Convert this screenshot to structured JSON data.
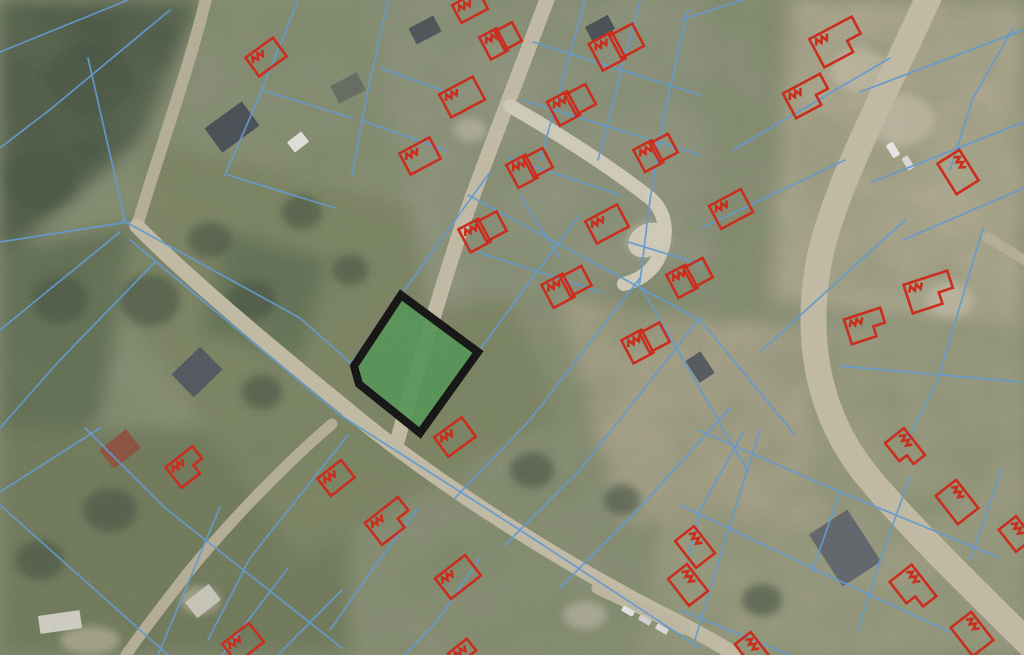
{
  "view": {
    "kind": "aerial-cadastral-map",
    "width": 1024,
    "height": 655
  },
  "palette": {
    "base": "#868c72",
    "forest_dark": "#44513f",
    "forest_mid": "#5a684e",
    "green_lowerleft": "#6d7557",
    "olive_center": "#7a8160",
    "pale_housing": "#8e927c",
    "tan_right": "#b1a991",
    "tan_olive_rb": "#9c9b81",
    "mid_dirt": "#a8a189",
    "dark_grove": "#5c6a50",
    "road_main": "#c1b9a3",
    "road_pale": "#d0cab7",
    "road_dirt": "#b4ac94",
    "parcel_boundary": "#5d97d1",
    "building_outline": "#cb2212",
    "highlight_fill": "#4f9352",
    "highlight_border": "#0a0a0a"
  },
  "map": {
    "patches": [
      {
        "pts": [
          [
            0,
            0
          ],
          [
            200,
            0
          ],
          [
            140,
            140
          ],
          [
            0,
            260
          ]
        ],
        "c": "#44513f"
      },
      {
        "pts": [
          [
            0,
            250
          ],
          [
            135,
            225
          ],
          [
            100,
            420
          ],
          [
            0,
            470
          ]
        ],
        "c": "#5a684e"
      },
      {
        "pts": [
          [
            0,
            430
          ],
          [
            345,
            430
          ],
          [
            350,
            655
          ],
          [
            0,
            655
          ]
        ],
        "c": "#6d7557"
      },
      {
        "pts": [
          [
            150,
            140
          ],
          [
            480,
            220
          ],
          [
            560,
            420
          ],
          [
            300,
            560
          ],
          [
            130,
            320
          ]
        ],
        "c": "#7a8160"
      },
      {
        "pts": [
          [
            370,
            0
          ],
          [
            700,
            0
          ],
          [
            720,
            260
          ],
          [
            430,
            310
          ]
        ],
        "c": "#8e927c"
      },
      {
        "pts": [
          [
            790,
            0
          ],
          [
            1024,
            0
          ],
          [
            1024,
            330
          ],
          [
            770,
            300
          ]
        ],
        "c": "#b1a991"
      },
      {
        "pts": [
          [
            690,
            320
          ],
          [
            1024,
            330
          ],
          [
            1024,
            655
          ],
          [
            640,
            655
          ]
        ],
        "c": "#9c9b81"
      },
      {
        "pts": [
          [
            560,
            300
          ],
          [
            800,
            330
          ],
          [
            820,
            520
          ],
          [
            620,
            520
          ]
        ],
        "c": "#a8a189"
      },
      {
        "pts": [
          [
            230,
            230
          ],
          [
            330,
            260
          ],
          [
            300,
            360
          ],
          [
            200,
            330
          ]
        ],
        "c": "#5c6a50"
      }
    ],
    "glades": [
      [
        900,
        120,
        34,
        26
      ],
      [
        860,
        70,
        28,
        22
      ],
      [
        950,
        300,
        24,
        18
      ],
      [
        648,
        240,
        22,
        17
      ],
      [
        585,
        615,
        22,
        14
      ],
      [
        200,
        600,
        20,
        14
      ],
      [
        90,
        640,
        30,
        14
      ],
      [
        470,
        130,
        16,
        12
      ]
    ],
    "trees": [
      [
        90,
        80,
        44,
        36
      ],
      [
        40,
        180,
        36,
        30
      ],
      [
        150,
        300,
        30,
        26
      ],
      [
        60,
        300,
        28,
        24
      ],
      [
        252,
        300,
        24,
        20
      ],
      [
        302,
        212,
        20,
        17
      ],
      [
        110,
        510,
        27,
        22
      ],
      [
        40,
        560,
        24,
        20
      ],
      [
        262,
        392,
        20,
        17
      ],
      [
        532,
        470,
        22,
        18
      ],
      [
        622,
        500,
        18,
        15
      ],
      [
        762,
        600,
        20,
        16
      ],
      [
        350,
        270,
        18,
        15
      ],
      [
        210,
        240,
        22,
        18
      ]
    ],
    "roads": [
      {
        "d": "M 207,-6 C 192,60 158,155 137,226",
        "w": 12,
        "c": "#b4ac94"
      },
      {
        "d": "M 549,-6 C 517,80 482,168 462,226 C 441,290 415,378 397,442",
        "w": 15,
        "c": "#c1b9a3"
      },
      {
        "d": "M 137,226 C 192,282 282,356 347,409 C 422,472 542,552 662,614 C 692,629 714,641 736,655",
        "w": 15,
        "c": "#c1b9a3"
      },
      {
        "d": "M 332,424 C 292,458 232,518 187,574 C 162,606 142,632 126,655",
        "w": 11,
        "c": "#b4ac94"
      },
      {
        "d": "M 930,-6 C 892,80 837,180 820,256 C 804,336 817,412 864,472 C 907,525 972,587 1032,647",
        "w": 26,
        "c": "#c1b9a3"
      },
      {
        "d": "M 987,237 L 1034,266",
        "w": 10,
        "c": "#b4ac94"
      },
      {
        "d": "M 510,106 C 556,132 612,168 650,198 C 666,212 668,232 661,252 C 655,270 640,280 624,284",
        "w": 14,
        "c": "#d0cab7"
      },
      {
        "d": "M 598,588 L 684,628",
        "w": 13,
        "c": "#bdb59f"
      }
    ],
    "road_bulbs": [
      [
        648,
        240,
        21,
        16,
        -30
      ]
    ],
    "parcel_lines": [
      [
        [
          128,
          0
        ],
        [
          0,
          52
        ]
      ],
      [
        [
          170,
          10
        ],
        [
          52,
          108
        ],
        [
          0,
          148
        ]
      ],
      [
        [
          88,
          58
        ],
        [
          125,
          220
        ]
      ],
      [
        [
          0,
          242
        ],
        [
          128,
          222
        ]
      ],
      [
        [
          120,
          232
        ],
        [
          0,
          330
        ]
      ],
      [
        [
          155,
          262
        ],
        [
          60,
          360
        ],
        [
          0,
          428
        ]
      ],
      [
        [
          85,
          428
        ],
        [
          165,
          508
        ],
        [
          342,
          648
        ]
      ],
      [
        [
          0,
          505
        ],
        [
          168,
          655
        ]
      ],
      [
        [
          100,
          428
        ],
        [
          0,
          492
        ]
      ],
      [
        [
          220,
          507
        ],
        [
          158,
          655
        ]
      ],
      [
        [
          288,
          568
        ],
        [
          222,
          655
        ]
      ],
      [
        [
          342,
          590
        ],
        [
          278,
          655
        ]
      ],
      [
        [
          130,
          240
        ],
        [
          340,
          415
        ],
        [
          520,
          530
        ],
        [
          700,
          648
        ]
      ],
      [
        [
          122,
          220
        ],
        [
          300,
          318
        ],
        [
          354,
          366
        ]
      ],
      [
        [
          352,
          362
        ],
        [
          401,
          295
        ],
        [
          490,
          172
        ]
      ],
      [
        [
          478,
          352
        ],
        [
          540,
          268
        ],
        [
          580,
          215
        ]
      ],
      [
        [
          455,
          498
        ],
        [
          530,
          420
        ],
        [
          640,
          278
        ]
      ],
      [
        [
          505,
          545
        ],
        [
          580,
          470
        ],
        [
          700,
          318
        ]
      ],
      [
        [
          560,
          588
        ],
        [
          645,
          502
        ],
        [
          730,
          408
        ]
      ],
      [
        [
          468,
          195
        ],
        [
          700,
          320
        ]
      ],
      [
        [
          638,
          282
        ],
        [
          748,
          472
        ]
      ],
      [
        [
          700,
          320
        ],
        [
          795,
          435
        ]
      ],
      [
        [
          533,
          42
        ],
        [
          700,
          95
        ]
      ],
      [
        [
          522,
          100
        ],
        [
          700,
          155
        ]
      ],
      [
        [
          508,
          158
        ],
        [
          620,
          195
        ]
      ],
      [
        [
          628,
          242
        ],
        [
          700,
          264
        ]
      ],
      [
        [
          478,
          252
        ],
        [
          600,
          292
        ]
      ],
      [
        [
          585,
          0
        ],
        [
          560,
          90
        ],
        [
          540,
          160
        ]
      ],
      [
        [
          640,
          0
        ],
        [
          615,
          95
        ],
        [
          598,
          160
        ]
      ],
      [
        [
          688,
          10
        ],
        [
          665,
          110
        ],
        [
          650,
          200
        ],
        [
          640,
          282
        ]
      ],
      [
        [
          458,
          96
        ],
        [
          380,
          68
        ]
      ],
      [
        [
          445,
          150
        ],
        [
          360,
          120
        ]
      ],
      [
        [
          388,
          0
        ],
        [
          368,
          90
        ],
        [
          352,
          175
        ]
      ],
      [
        [
          298,
          0
        ],
        [
          262,
          90
        ],
        [
          225,
          175
        ]
      ],
      [
        [
          262,
          90
        ],
        [
          352,
          118
        ]
      ],
      [
        [
          228,
          175
        ],
        [
          335,
          208
        ]
      ],
      [
        [
          1013,
          28
        ],
        [
          973,
          98
        ],
        [
          950,
          170
        ]
      ],
      [
        [
          860,
          92
        ],
        [
          1023,
          30
        ]
      ],
      [
        [
          872,
          182
        ],
        [
          1024,
          122
        ]
      ],
      [
        [
          903,
          240
        ],
        [
          1024,
          188
        ]
      ],
      [
        [
          733,
          150
        ],
        [
          890,
          58
        ]
      ],
      [
        [
          680,
          20
        ],
        [
          743,
          0
        ]
      ],
      [
        [
          702,
          228
        ],
        [
          845,
          160
        ]
      ],
      [
        [
          905,
          220
        ],
        [
          760,
          352
        ]
      ],
      [
        [
          983,
          228
        ],
        [
          938,
          380
        ],
        [
          908,
          438
        ]
      ],
      [
        [
          840,
          366
        ],
        [
          1021,
          382
        ]
      ],
      [
        [
          698,
          430
        ],
        [
          840,
          492
        ],
        [
          1000,
          558
        ]
      ],
      [
        [
          680,
          505
        ],
        [
          823,
          573
        ],
        [
          950,
          632
        ]
      ],
      [
        [
          680,
          610
        ],
        [
          790,
          655
        ]
      ],
      [
        [
          760,
          430
        ],
        [
          712,
          582
        ],
        [
          695,
          640
        ]
      ],
      [
        [
          910,
          477
        ],
        [
          880,
          560
        ],
        [
          858,
          630
        ]
      ],
      [
        [
          1002,
          468
        ],
        [
          970,
          560
        ]
      ],
      [
        [
          840,
          492
        ],
        [
          812,
          572
        ]
      ],
      [
        [
          348,
          435
        ],
        [
          250,
          558
        ],
        [
          208,
          640
        ]
      ],
      [
        [
          418,
          508
        ],
        [
          372,
          570
        ],
        [
          330,
          630
        ]
      ],
      [
        [
          480,
          558
        ],
        [
          438,
          620
        ],
        [
          405,
          655
        ]
      ],
      [
        [
          520,
          195
        ],
        [
          560,
          258
        ]
      ],
      [
        [
          743,
          433
        ],
        [
          700,
          510
        ],
        [
          688,
          560
        ]
      ]
    ],
    "roofs": [
      [
        232,
        127,
        46,
        30,
        -36,
        "#3e464e"
      ],
      [
        197,
        372,
        40,
        32,
        -44,
        "#49505a"
      ],
      [
        845,
        548,
        62,
        46,
        57,
        "#585e66"
      ],
      [
        120,
        449,
        34,
        24,
        -38,
        "#8a4a38"
      ],
      [
        348,
        88,
        30,
        20,
        -28,
        "#5f655c"
      ],
      [
        298,
        142,
        18,
        13,
        -38,
        "#e6e6e0"
      ],
      [
        203,
        601,
        30,
        20,
        -38,
        "#c9c6bb"
      ],
      [
        60,
        622,
        42,
        18,
        -8,
        "#d4d2c8"
      ],
      [
        700,
        367,
        26,
        18,
        57,
        "#4a5056"
      ],
      [
        425,
        30,
        28,
        18,
        -28,
        "#454c52"
      ],
      [
        600,
        28,
        26,
        16,
        -28,
        "#3f464d"
      ]
    ],
    "cars": [
      [
        893,
        150,
        15,
        8,
        58,
        "#e8e8e8"
      ],
      [
        908,
        163,
        14,
        7,
        58,
        "#d8d8d6"
      ],
      [
        628,
        611,
        13,
        6,
        30,
        "#e4e4e2"
      ],
      [
        645,
        620,
        13,
        6,
        30,
        "#d0d0ce"
      ],
      [
        662,
        629,
        13,
        6,
        30,
        "#dadad8"
      ]
    ],
    "buildings": [
      [
        266,
        57,
        34,
        23,
        -36,
        "s"
      ],
      [
        470,
        7,
        30,
        20,
        -28,
        "s"
      ],
      [
        501,
        40,
        36,
        25,
        -28,
        "d"
      ],
      [
        462,
        97,
        38,
        26,
        -28,
        "s"
      ],
      [
        420,
        156,
        34,
        24,
        -28,
        "s"
      ],
      [
        617,
        46,
        48,
        30,
        -28,
        "d"
      ],
      [
        572,
        104,
        42,
        27,
        -28,
        "d"
      ],
      [
        530,
        167,
        40,
        26,
        -28,
        "d"
      ],
      [
        656,
        152,
        38,
        25,
        -28,
        "d"
      ],
      [
        483,
        231,
        42,
        26,
        -28,
        "d"
      ],
      [
        607,
        224,
        36,
        25,
        -28,
        "s"
      ],
      [
        567,
        286,
        44,
        26,
        -28,
        "d"
      ],
      [
        690,
        277,
        40,
        26,
        -28,
        "d"
      ],
      [
        646,
        342,
        42,
        26,
        -28,
        "d"
      ],
      [
        731,
        209,
        36,
        26,
        -28,
        "s"
      ],
      [
        838,
        42,
        48,
        32,
        -28,
        "l"
      ],
      [
        808,
        96,
        42,
        28,
        -28,
        "l"
      ],
      [
        958,
        172,
        36,
        26,
        58,
        "s"
      ],
      [
        930,
        292,
        46,
        30,
        -18,
        "l"
      ],
      [
        866,
        326,
        38,
        26,
        -18,
        "l"
      ],
      [
        455,
        437,
        34,
        24,
        -36,
        "s"
      ],
      [
        390,
        521,
        42,
        28,
        -38,
        "l"
      ],
      [
        458,
        577,
        38,
        26,
        -38,
        "s"
      ],
      [
        336,
        478,
        30,
        22,
        -38,
        "s"
      ],
      [
        187,
        467,
        34,
        26,
        -38,
        "l"
      ],
      [
        243,
        643,
        34,
        24,
        -38,
        "s"
      ],
      [
        462,
        652,
        24,
        15,
        -38,
        "s"
      ],
      [
        695,
        547,
        34,
        24,
        52,
        "s"
      ],
      [
        688,
        585,
        34,
        24,
        52,
        "s"
      ],
      [
        913,
        589,
        40,
        28,
        52,
        "l"
      ],
      [
        972,
        634,
        36,
        26,
        52,
        "s"
      ],
      [
        752,
        650,
        30,
        20,
        52,
        "s"
      ],
      [
        905,
        449,
        34,
        24,
        52,
        "l"
      ],
      [
        957,
        502,
        36,
        26,
        52,
        "s"
      ],
      [
        1016,
        534,
        28,
        22,
        52,
        "s"
      ]
    ],
    "highlight_parcel": {
      "points": [
        [
          401,
          295
        ],
        [
          478,
          352
        ],
        [
          420,
          433
        ],
        [
          359,
          384
        ],
        [
          354,
          366
        ]
      ],
      "fill": "#4f9352",
      "fill_opacity": 0.92,
      "stroke": "#0a0a0a",
      "stroke_width": 8
    }
  }
}
